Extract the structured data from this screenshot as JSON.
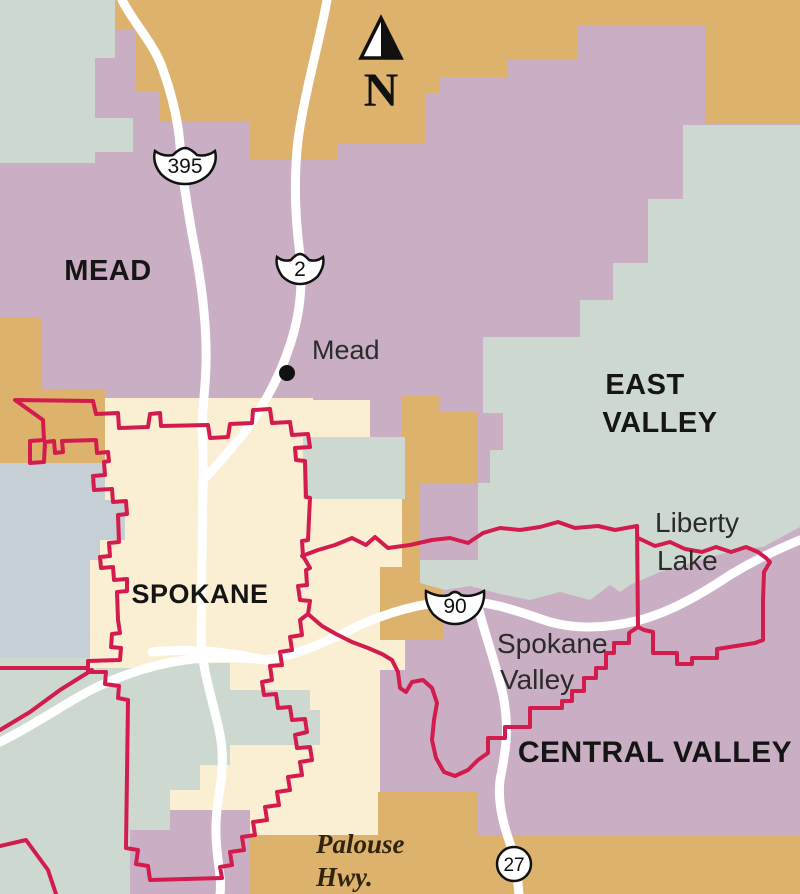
{
  "map_type": "district-map",
  "colors": {
    "tan": "#dcb26d",
    "mauve": "#c9aec4",
    "teal": "#cdd8d1",
    "bluegray": "#c6ced6",
    "cream": "#faefd2",
    "boundary_red": "#d31b4d",
    "road_white": "#ffffff",
    "shield_fill": "#ffffff",
    "shield_stroke": "#111111",
    "town_dot": "#111111"
  },
  "districts": {
    "mead": "MEAD",
    "east_valley_line1": "EAST",
    "east_valley_line2": "VALLEY",
    "spokane": "SPOKANE",
    "central_valley": "CENTRAL VALLEY"
  },
  "places": {
    "mead_town": "Mead",
    "liberty_lake_line1": "Liberty",
    "liberty_lake_line2": "Lake",
    "spokane_valley_line1": "Spokane",
    "spokane_valley_line2": "Valley"
  },
  "roads": {
    "us395_shield": "395",
    "us2_shield": "2",
    "i90_shield": "90",
    "wa27_shield": "27",
    "palouse_line1": "Palouse",
    "palouse_line2": "Hwy."
  },
  "compass": {
    "north_label": "N"
  }
}
